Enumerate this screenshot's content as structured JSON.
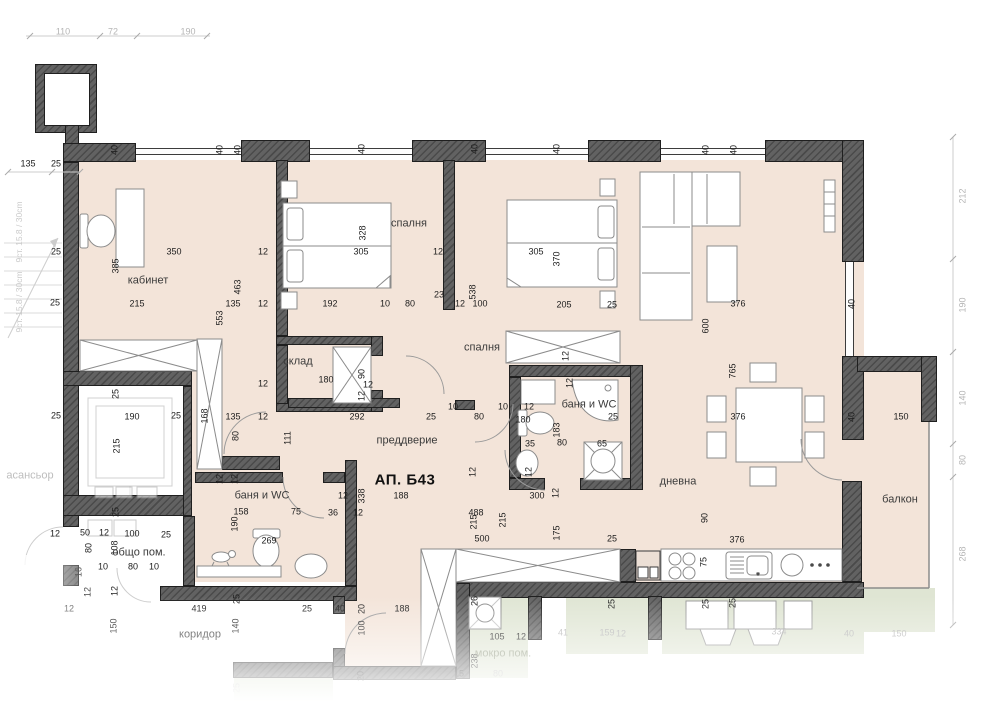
{
  "title": {
    "apartment": "АП. Б43"
  },
  "colors": {
    "floor_fill": "#f3e4d9",
    "wall_fill": "#626262",
    "outline": "#1f1f1f",
    "green_fill": "#dfe5d3",
    "dim_color": "#1c1c1c",
    "faded_color": "#b5b5b5"
  },
  "rooms": [
    {
      "id": "office",
      "label": "кабинет",
      "x": 148,
      "y": 281
    },
    {
      "id": "bedroom-1",
      "label": "спалня",
      "x": 409,
      "y": 224
    },
    {
      "id": "bedroom-2",
      "label": "спалня",
      "x": 482,
      "y": 348
    },
    {
      "id": "storage",
      "label": "склад",
      "x": 298,
      "y": 362
    },
    {
      "id": "vestibule",
      "label": "преддверие",
      "x": 407,
      "y": 441
    },
    {
      "id": "bath-wc-1",
      "label": "баня и WC",
      "x": 589,
      "y": 405
    },
    {
      "id": "bath-wc-2",
      "label": "баня и WC",
      "x": 262,
      "y": 496
    },
    {
      "id": "living-room",
      "label": "дневна",
      "x": 678,
      "y": 482
    },
    {
      "id": "balcony",
      "label": "балкон",
      "x": 900,
      "y": 500
    },
    {
      "id": "corridor",
      "label": "коридор",
      "x": 200,
      "y": 635
    },
    {
      "id": "common-room",
      "label": "общо пом.",
      "x": 139,
      "y": 553
    },
    {
      "id": "wet-room",
      "label": "мокро пом.",
      "x": 503,
      "y": 654,
      "cls": "g"
    },
    {
      "id": "elevator",
      "label": "асансьор",
      "x": 30,
      "y": 476,
      "cls": "f"
    }
  ],
  "annotations": [
    {
      "t": "9ст. 15.8 / 30cm",
      "x": 19,
      "y": 232
    },
    {
      "t": "9ст. 15.8 / 30cm",
      "x": 19,
      "y": 302
    }
  ],
  "dims": [
    {
      "t": "110",
      "x": 63,
      "y": 32,
      "f": 1
    },
    {
      "t": "72",
      "x": 113,
      "y": 32,
      "f": 1
    },
    {
      "t": "190",
      "x": 188,
      "y": 32,
      "f": 1
    },
    {
      "t": "212",
      "x": 963,
      "y": 196,
      "r": 1,
      "f": 1
    },
    {
      "t": "190",
      "x": 963,
      "y": 305,
      "r": 1,
      "f": 1
    },
    {
      "t": "140",
      "x": 963,
      "y": 398,
      "r": 1,
      "f": 1
    },
    {
      "t": "80",
      "x": 963,
      "y": 460,
      "r": 1,
      "f": 1
    },
    {
      "t": "268",
      "x": 963,
      "y": 554,
      "r": 1,
      "f": 1
    },
    {
      "t": "135",
      "x": 28,
      "y": 164
    },
    {
      "t": "25",
      "x": 56,
      "y": 164
    },
    {
      "t": "25",
      "x": 56,
      "y": 252
    },
    {
      "t": "25",
      "x": 55,
      "y": 303
    },
    {
      "t": "25",
      "x": 56,
      "y": 416
    },
    {
      "t": "40",
      "x": 115,
      "y": 150,
      "r": 1
    },
    {
      "t": "40",
      "x": 220,
      "y": 150,
      "r": 1
    },
    {
      "t": "40",
      "x": 238,
      "y": 150,
      "r": 1
    },
    {
      "t": "40",
      "x": 362,
      "y": 149,
      "r": 1
    },
    {
      "t": "40",
      "x": 475,
      "y": 149,
      "r": 1
    },
    {
      "t": "40",
      "x": 557,
      "y": 149,
      "r": 1
    },
    {
      "t": "40",
      "x": 706,
      "y": 150,
      "r": 1
    },
    {
      "t": "40",
      "x": 734,
      "y": 150,
      "r": 1
    },
    {
      "t": "350",
      "x": 174,
      "y": 252
    },
    {
      "t": "385",
      "x": 116,
      "y": 266,
      "r": 1
    },
    {
      "t": "12",
      "x": 263,
      "y": 252
    },
    {
      "t": "215",
      "x": 137,
      "y": 304
    },
    {
      "t": "463",
      "x": 238,
      "y": 287,
      "r": 1
    },
    {
      "t": "135",
      "x": 233,
      "y": 304
    },
    {
      "t": "12",
      "x": 263,
      "y": 304
    },
    {
      "t": "553",
      "x": 220,
      "y": 318,
      "r": 1
    },
    {
      "t": "328",
      "x": 363,
      "y": 233,
      "r": 1
    },
    {
      "t": "305",
      "x": 361,
      "y": 252
    },
    {
      "t": "12",
      "x": 438,
      "y": 252
    },
    {
      "t": "192",
      "x": 330,
      "y": 304
    },
    {
      "t": "10",
      "x": 385,
      "y": 304
    },
    {
      "t": "80",
      "x": 410,
      "y": 304
    },
    {
      "t": "23",
      "x": 439,
      "y": 295
    },
    {
      "t": "12",
      "x": 460,
      "y": 304
    },
    {
      "t": "538",
      "x": 473,
      "y": 292,
      "r": 1
    },
    {
      "t": "100",
      "x": 480,
      "y": 304
    },
    {
      "t": "305",
      "x": 536,
      "y": 252
    },
    {
      "t": "370",
      "x": 557,
      "y": 259,
      "r": 1
    },
    {
      "t": "205",
      "x": 564,
      "y": 305
    },
    {
      "t": "25",
      "x": 612,
      "y": 305
    },
    {
      "t": "12",
      "x": 566,
      "y": 356,
      "r": 1
    },
    {
      "t": "376",
      "x": 738,
      "y": 304
    },
    {
      "t": "600",
      "x": 706,
      "y": 326,
      "r": 1
    },
    {
      "t": "765",
      "x": 733,
      "y": 371,
      "r": 1
    },
    {
      "t": "376",
      "x": 738,
      "y": 417
    },
    {
      "t": "376",
      "x": 737,
      "y": 540
    },
    {
      "t": "90",
      "x": 705,
      "y": 518,
      "r": 1
    },
    {
      "t": "75",
      "x": 704,
      "y": 562,
      "r": 1
    },
    {
      "t": "40",
      "x": 852,
      "y": 304,
      "r": 1
    },
    {
      "t": "40",
      "x": 852,
      "y": 417,
      "r": 1
    },
    {
      "t": "150",
      "x": 901,
      "y": 417
    },
    {
      "t": "180",
      "x": 326,
      "y": 380
    },
    {
      "t": "12",
      "x": 263,
      "y": 384
    },
    {
      "t": "135",
      "x": 233,
      "y": 417
    },
    {
      "t": "12",
      "x": 263,
      "y": 417
    },
    {
      "t": "168",
      "x": 205,
      "y": 416,
      "r": 1
    },
    {
      "t": "80",
      "x": 236,
      "y": 436,
      "r": 1
    },
    {
      "t": "190",
      "x": 132,
      "y": 417
    },
    {
      "t": "25",
      "x": 176,
      "y": 416
    },
    {
      "t": "215",
      "x": 117,
      "y": 446,
      "r": 1
    },
    {
      "t": "25",
      "x": 116,
      "y": 394,
      "r": 1
    },
    {
      "t": "111",
      "x": 288,
      "y": 438,
      "r": 1
    },
    {
      "t": "90",
      "x": 362,
      "y": 374,
      "r": 1
    },
    {
      "t": "12",
      "x": 368,
      "y": 385
    },
    {
      "t": "12",
      "x": 362,
      "y": 396,
      "r": 1
    },
    {
      "t": "292",
      "x": 357,
      "y": 417
    },
    {
      "t": "25",
      "x": 431,
      "y": 417
    },
    {
      "t": "80",
      "x": 479,
      "y": 417
    },
    {
      "t": "10",
      "x": 453,
      "y": 407
    },
    {
      "t": "10",
      "x": 503,
      "y": 407
    },
    {
      "t": "12",
      "x": 529,
      "y": 407
    },
    {
      "t": "12",
      "x": 570,
      "y": 383,
      "r": 1
    },
    {
      "t": "180",
      "x": 523,
      "y": 420
    },
    {
      "t": "183",
      "x": 557,
      "y": 430,
      "r": 1
    },
    {
      "t": "25",
      "x": 613,
      "y": 417
    },
    {
      "t": "35",
      "x": 530,
      "y": 444
    },
    {
      "t": "80",
      "x": 562,
      "y": 443
    },
    {
      "t": "65",
      "x": 602,
      "y": 444
    },
    {
      "t": "12",
      "x": 529,
      "y": 472,
      "r": 1
    },
    {
      "t": "300",
      "x": 537,
      "y": 496
    },
    {
      "t": "12",
      "x": 556,
      "y": 493,
      "r": 1
    },
    {
      "t": "12",
      "x": 343,
      "y": 496
    },
    {
      "t": "338",
      "x": 362,
      "y": 496,
      "r": 1
    },
    {
      "t": "188",
      "x": 401,
      "y": 496
    },
    {
      "t": "36",
      "x": 333,
      "y": 513
    },
    {
      "t": "12",
      "x": 358,
      "y": 513
    },
    {
      "t": "12",
      "x": 473,
      "y": 472,
      "r": 1
    },
    {
      "t": "488",
      "x": 476,
      "y": 513
    },
    {
      "t": "215",
      "x": 474,
      "y": 522,
      "r": 1
    },
    {
      "t": "215",
      "x": 503,
      "y": 520,
      "r": 1
    },
    {
      "t": "500",
      "x": 482,
      "y": 539
    },
    {
      "t": "175",
      "x": 557,
      "y": 533,
      "r": 1
    },
    {
      "t": "25",
      "x": 612,
      "y": 539
    },
    {
      "t": "12",
      "x": 220,
      "y": 479,
      "r": 1
    },
    {
      "t": "12",
      "x": 235,
      "y": 479,
      "r": 1
    },
    {
      "t": "158",
      "x": 241,
      "y": 512
    },
    {
      "t": "75",
      "x": 296,
      "y": 512
    },
    {
      "t": "190",
      "x": 235,
      "y": 524,
      "r": 1
    },
    {
      "t": "269",
      "x": 269,
      "y": 541
    },
    {
      "t": "12",
      "x": 55,
      "y": 534
    },
    {
      "t": "50",
      "x": 85,
      "y": 533
    },
    {
      "t": "12",
      "x": 104,
      "y": 533
    },
    {
      "t": "100",
      "x": 132,
      "y": 534
    },
    {
      "t": "25",
      "x": 166,
      "y": 535
    },
    {
      "t": "80",
      "x": 89,
      "y": 548,
      "r": 1
    },
    {
      "t": "108",
      "x": 115,
      "y": 548,
      "r": 1
    },
    {
      "t": "25",
      "x": 116,
      "y": 512,
      "r": 1
    },
    {
      "t": "16",
      "x": 79,
      "y": 572,
      "r": 1
    },
    {
      "t": "10",
      "x": 103,
      "y": 567
    },
    {
      "t": "80",
      "x": 133,
      "y": 567
    },
    {
      "t": "10",
      "x": 154,
      "y": 567
    },
    {
      "t": "12",
      "x": 88,
      "y": 592,
      "r": 1
    },
    {
      "t": "12",
      "x": 115,
      "y": 591,
      "r": 1
    },
    {
      "t": "12",
      "x": 69,
      "y": 609
    },
    {
      "t": "419",
      "x": 199,
      "y": 609
    },
    {
      "t": "150",
      "x": 114,
      "y": 626,
      "r": 1
    },
    {
      "t": "140",
      "x": 236,
      "y": 626,
      "r": 1
    },
    {
      "t": "25",
      "x": 237,
      "y": 599,
      "r": 1
    },
    {
      "t": "25",
      "x": 307,
      "y": 609
    },
    {
      "t": "25",
      "x": 237,
      "y": 688,
      "r": 1,
      "f": 1
    },
    {
      "t": "40",
      "x": 340,
      "y": 609
    },
    {
      "t": "20",
      "x": 362,
      "y": 609,
      "r": 1
    },
    {
      "t": "188",
      "x": 402,
      "y": 609
    },
    {
      "t": "100",
      "x": 362,
      "y": 628,
      "r": 1
    },
    {
      "t": "20",
      "x": 361,
      "y": 676,
      "r": 1
    },
    {
      "t": "15",
      "x": 459,
      "y": 674
    },
    {
      "t": "25",
      "x": 706,
      "y": 604,
      "r": 1
    },
    {
      "t": "25",
      "x": 733,
      "y": 603,
      "r": 1
    },
    {
      "t": "26",
      "x": 475,
      "y": 601,
      "r": 1
    },
    {
      "t": "105",
      "x": 497,
      "y": 637
    },
    {
      "t": "12",
      "x": 521,
      "y": 637
    },
    {
      "t": "238",
      "x": 475,
      "y": 661,
      "r": 1
    },
    {
      "t": "80",
      "x": 498,
      "y": 674,
      "f": 1
    },
    {
      "t": "41",
      "x": 563,
      "y": 633,
      "f": 1
    },
    {
      "t": "159",
      "x": 607,
      "y": 633,
      "f": 1
    },
    {
      "t": "12",
      "x": 621,
      "y": 634,
      "f": 1
    },
    {
      "t": "25",
      "x": 612,
      "y": 604,
      "r": 1
    },
    {
      "t": "334",
      "x": 779,
      "y": 632,
      "f": 1
    },
    {
      "t": "40",
      "x": 849,
      "y": 634,
      "f": 1
    },
    {
      "t": "150",
      "x": 899,
      "y": 634,
      "f": 1
    }
  ]
}
